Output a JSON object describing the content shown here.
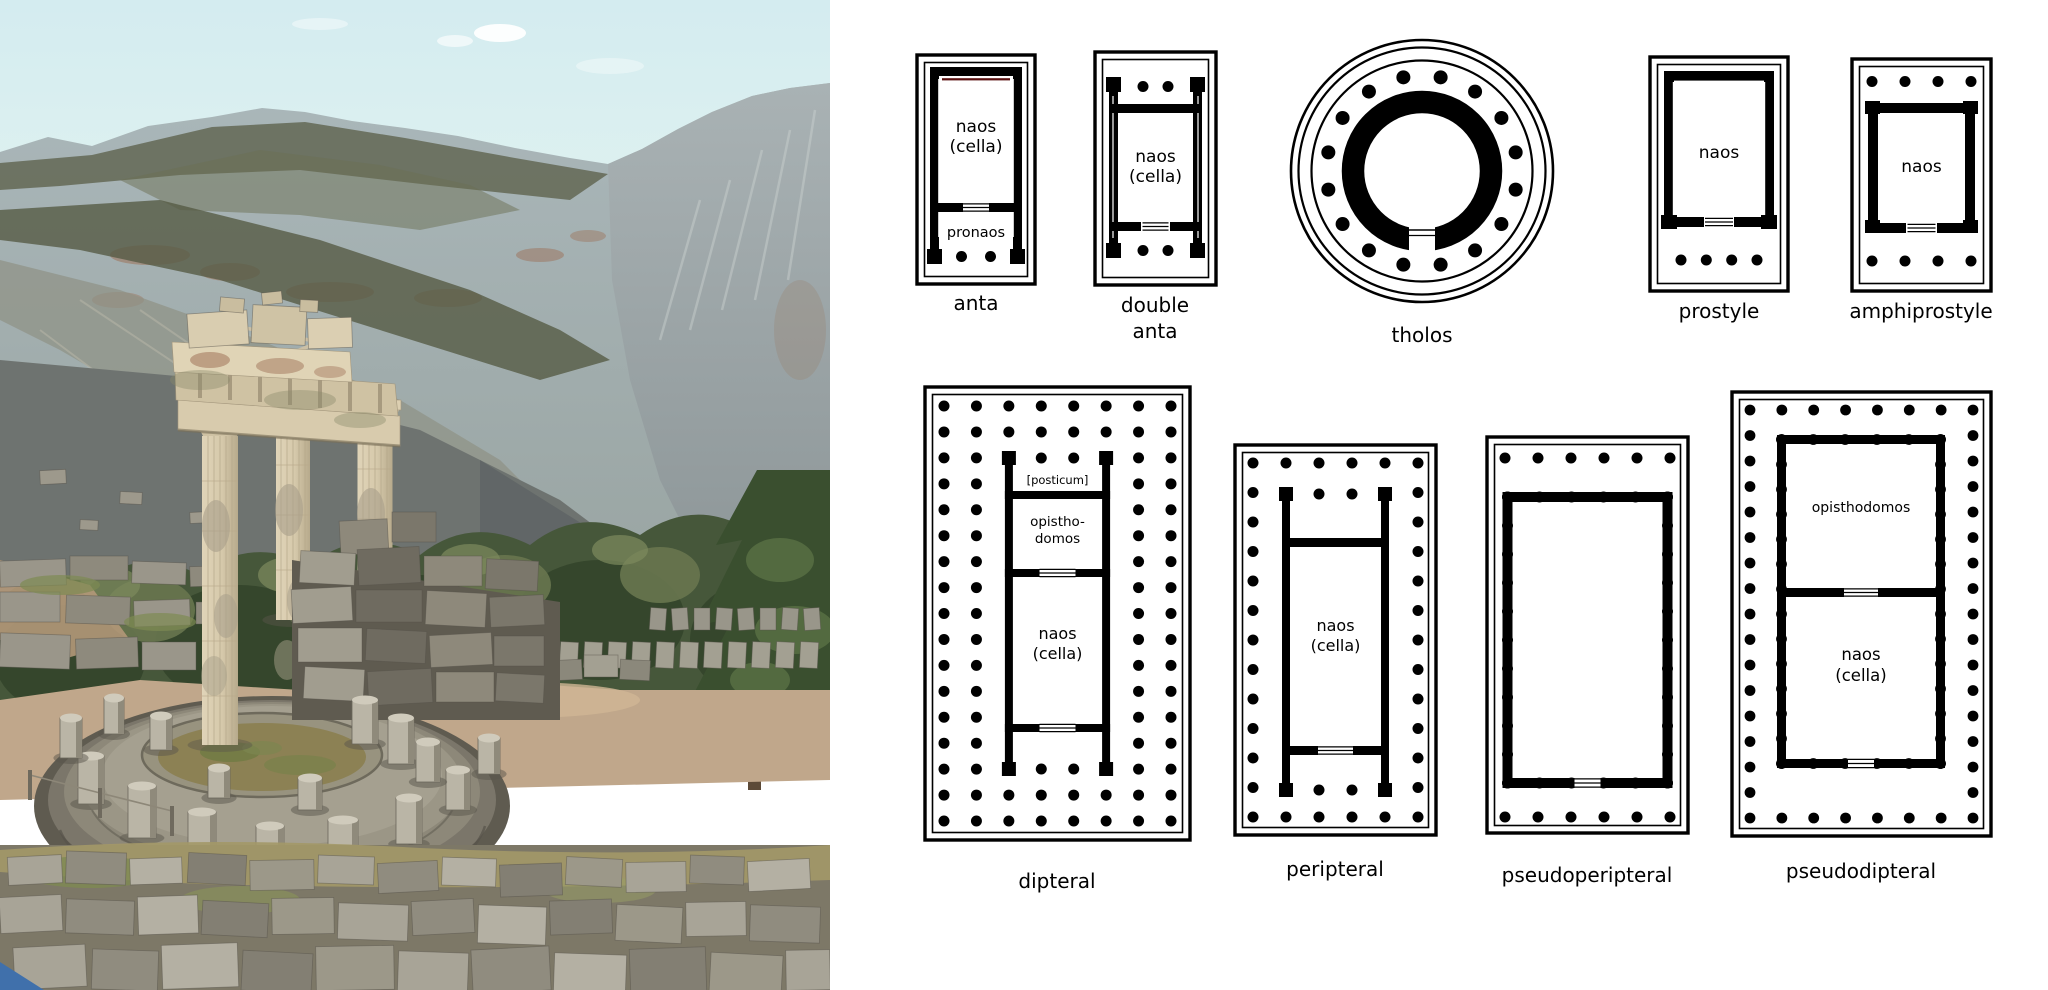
{
  "page": {
    "background": "#ffffff"
  },
  "photo": {
    "description": "circular ruin with three standing columns on stepped platform, mountains, trees, scattered stone blocks",
    "colors": {
      "sky": "#d4ecf0",
      "sky_low": "#ecf7f1",
      "cloud": "#ffffff",
      "mountain_far": "#aab7ba",
      "mountain_far_low": "#97a29f",
      "mountain_right": "#a9b2b4",
      "mountain_right_low": "#8b9496",
      "ridge_forest": "#5a5e47",
      "scree_red": "#9b6b50",
      "rock_shadow": "#6e7370",
      "rock_shadow_dark": "#5f6566",
      "trees_dark": "#35462c",
      "trees_mid": "#46573a",
      "trees_light": "#68764f",
      "ground_tan": "#c0a78b",
      "dirt": "#b39879",
      "stone_grey": "#9a968a",
      "stone_dark": "#7b776b",
      "column_light": "#e0d4b8",
      "column_cream": "#d6c9ab",
      "column_shade": "#b7aa8c",
      "platform_dark": "#5f5b50",
      "platform_grey": "#8d8879",
      "platform_light": "#a5a090",
      "grass_ring": "#8c8154",
      "grass_dry": "#a39868",
      "grass_green": "#7e8a52",
      "sign_blue": "#4070ab"
    }
  },
  "diagrams": {
    "background": "#ffffff",
    "line_color": "#000000",
    "text_color": "#000000",
    "accent_red_line": "#5a0e0e",
    "plans": [
      {
        "id": "anta",
        "label": "anta",
        "cella_label": [
          "naos",
          "(cella)"
        ],
        "porch_label": "pronaos",
        "front_dots": 2
      },
      {
        "id": "double-anta",
        "label": "double\nanta",
        "cella_label": [
          "naos",
          "(cella)"
        ],
        "front_dots": 2,
        "back_dots": 2
      },
      {
        "id": "tholos",
        "label": "tholos",
        "ring_dots": 16
      },
      {
        "id": "prostyle",
        "label": "prostyle",
        "cella_label": [
          "naos"
        ],
        "front_dots": 4
      },
      {
        "id": "amphiprostyle",
        "label": "amphiprostyle",
        "cella_label": [
          "naos"
        ],
        "front_dots": 4,
        "back_dots": 4
      },
      {
        "id": "dipteral",
        "label": "dipteral",
        "posticum_label": "[posticum]",
        "opisthodomos_label": [
          "opistho-",
          "domos"
        ],
        "cella_label": [
          "naos",
          "(cella)"
        ],
        "outer_cols": 8,
        "outer_rows": 17,
        "inner_cols": 6,
        "inner_rows": 15,
        "porch_dots": 2
      },
      {
        "id": "peripteral",
        "label": "peripteral",
        "cella_label": [
          "naos",
          "(cella)"
        ],
        "outer_cols": 6,
        "outer_rows": 13,
        "porch_dots": 2
      },
      {
        "id": "pseudoperipteral",
        "label": "pseudoperipteral",
        "front_dots": 6,
        "back_dots": 6,
        "engaged_side_dots": 11,
        "engaged_end_dots": 6
      },
      {
        "id": "pseudodipteral",
        "label": "pseudodipteral",
        "opisthodomos_label": [
          "opisthodomos"
        ],
        "cella_label": [
          "naos",
          "(cella)"
        ],
        "outer_cols": 8,
        "outer_rows": 17,
        "engaged_side_dots": 14,
        "engaged_end_dots": 6
      }
    ]
  }
}
